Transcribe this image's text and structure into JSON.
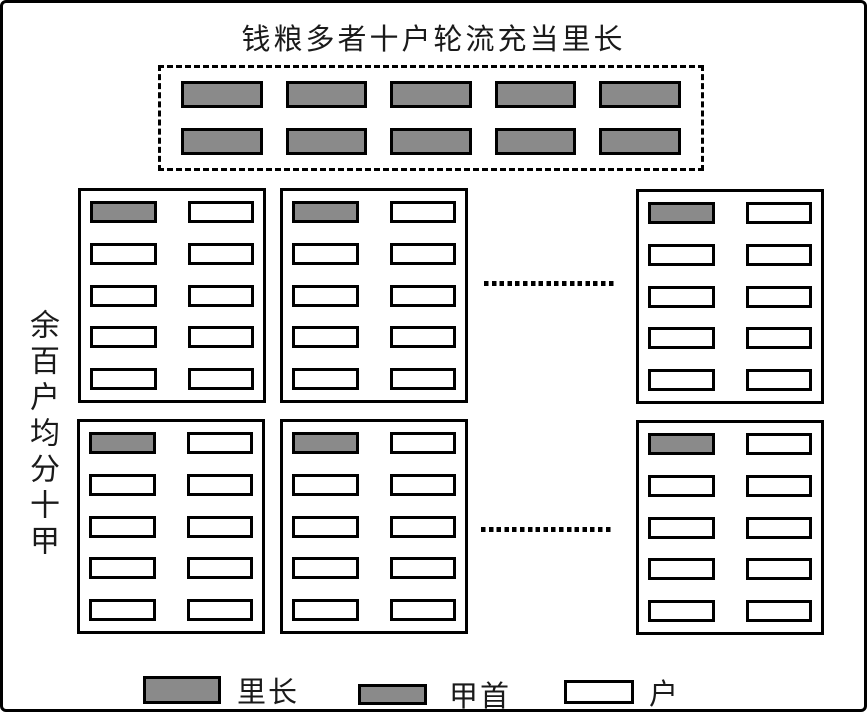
{
  "title": "钱粮多者十户轮流充当里长",
  "side_label": "余百户均分十甲",
  "lizhang_group": {
    "unit_count": 10,
    "rows": 2,
    "cols": 5
  },
  "jia_grid": {
    "box_count": 6,
    "rows_per_box": 5,
    "cols_per_box": 2,
    "jiashou_per_box": 1,
    "household_per_box": 9
  },
  "legend": {
    "items": [
      {
        "label": "里长",
        "swatch": "gray-large"
      },
      {
        "label": "甲首",
        "swatch": "gray-small"
      },
      {
        "label": "户",
        "swatch": "white"
      }
    ]
  },
  "colors": {
    "leader_fill": "#8a8a8a",
    "household_fill": "#ffffff",
    "line": "#000000",
    "background": "#ffffff"
  }
}
